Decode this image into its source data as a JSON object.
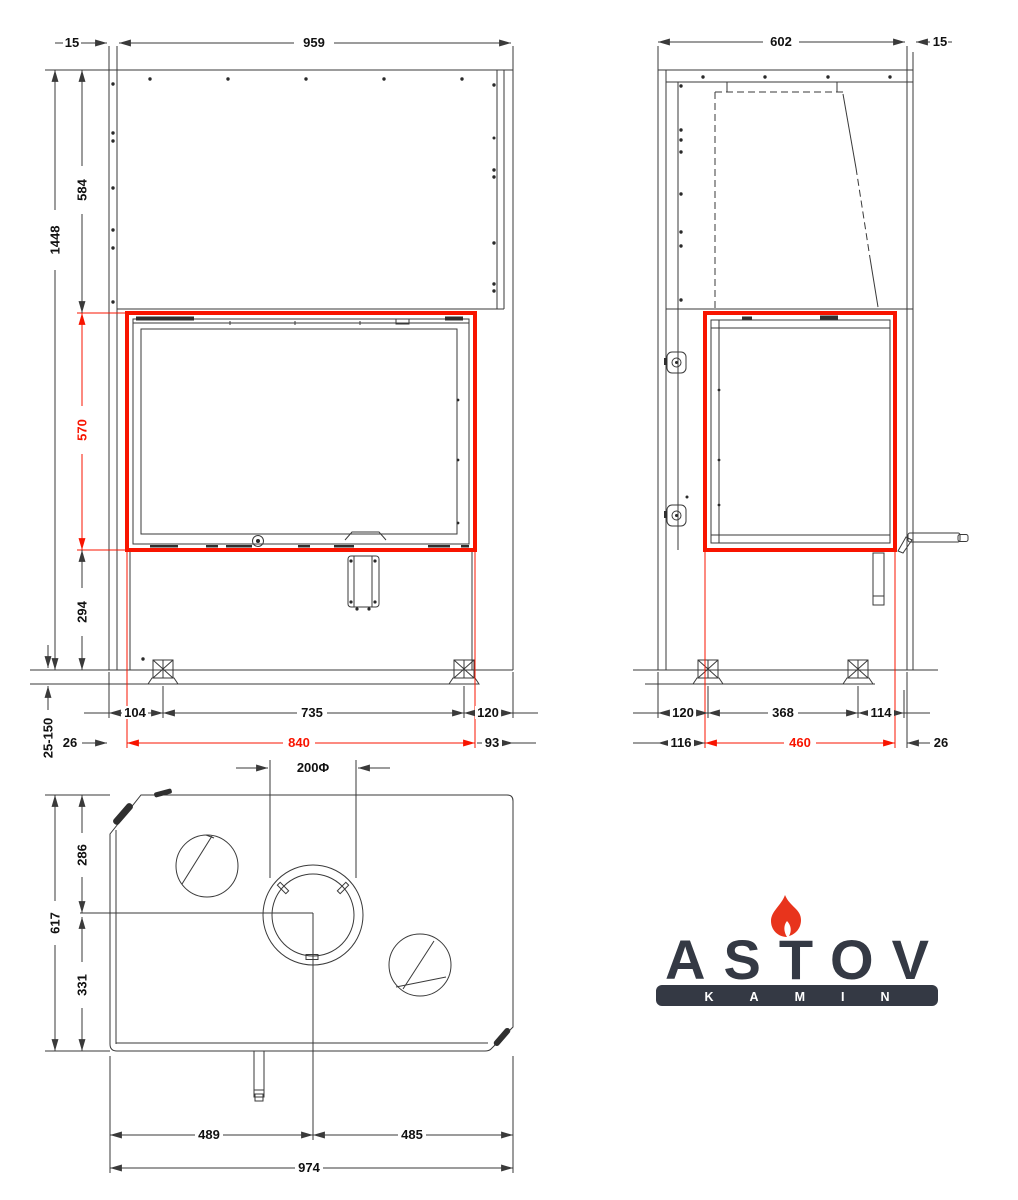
{
  "logo": {
    "brand": "ASTOV",
    "subtitle": "KAMIN"
  },
  "colors": {
    "highlight_red": "#f81400",
    "line_dark": "#3a3a3a",
    "logo_dark": "#343944",
    "flame_red": "#e8341c",
    "background": "#ffffff"
  },
  "views": {
    "front": {
      "dims": {
        "wall_offset": "15",
        "body_width": "959",
        "total_height": "1448",
        "upper_height": "584",
        "glass_height": "570",
        "base_height": "294",
        "leg_range": "25-150",
        "edge_to_leg": "104",
        "leg_spacing": "735",
        "leg_to_edge": "120",
        "left_margin": "26",
        "glass_width": "840",
        "right_margin": "93"
      }
    },
    "side": {
      "dims": {
        "body_depth": "602",
        "wall_offset": "15",
        "back_to_leg": "120",
        "leg_spacing": "368",
        "leg_to_front": "114",
        "back_margin": "116",
        "glass_depth": "460",
        "front_margin": "26"
      }
    },
    "top": {
      "dims": {
        "flue_diameter": "200Φ",
        "back_to_flue": "286",
        "flue_to_front": "331",
        "total_depth": "617",
        "left_to_flue": "489",
        "flue_to_right": "485",
        "total_width": "974"
      }
    }
  }
}
